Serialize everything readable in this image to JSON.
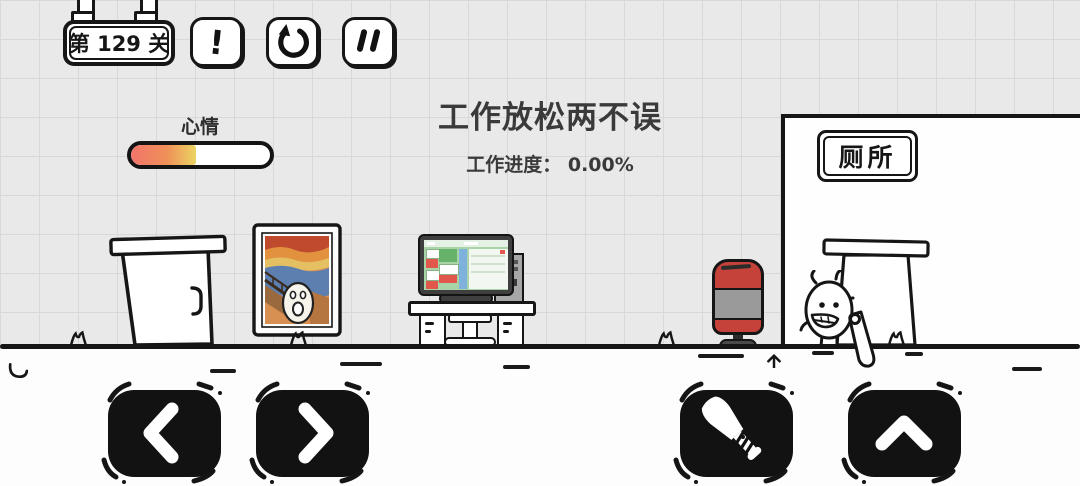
{
  "header": {
    "level_badge": {
      "label": "第 129 关"
    },
    "alert_button": {
      "glyph": "!",
      "icon": "exclamation-icon"
    },
    "restart_button": {
      "icon": "restart-arrow-icon"
    },
    "pause_button": {
      "icon": "pause-icon"
    }
  },
  "hud": {
    "mood_label": "心情",
    "mood_percent": 47,
    "title": "工作放松两不误",
    "progress_label": "工作进度：",
    "progress_value": "0.00%"
  },
  "scene": {
    "toilet_sign": "厕所",
    "items": [
      "office-door",
      "scream-painting",
      "computer-desk",
      "monitor",
      "pc-tower",
      "punching-bag",
      "toilet-door",
      "egg-character",
      "baseball-bat"
    ]
  },
  "controls": [
    {
      "name": "move-left",
      "icon": "chevron-left-icon"
    },
    {
      "name": "move-right",
      "icon": "chevron-right-icon"
    },
    {
      "name": "use-bat",
      "icon": "baseball-bat-icon"
    },
    {
      "name": "jump",
      "icon": "chevron-up-icon"
    }
  ],
  "colors": {
    "ink": "#161616",
    "bag_red": "#c5423a",
    "bag_gray": "#9a9a9a",
    "mood_start": "#f2756b",
    "mood_end": "#ecd464",
    "screen_green": "#a8d4a8"
  }
}
